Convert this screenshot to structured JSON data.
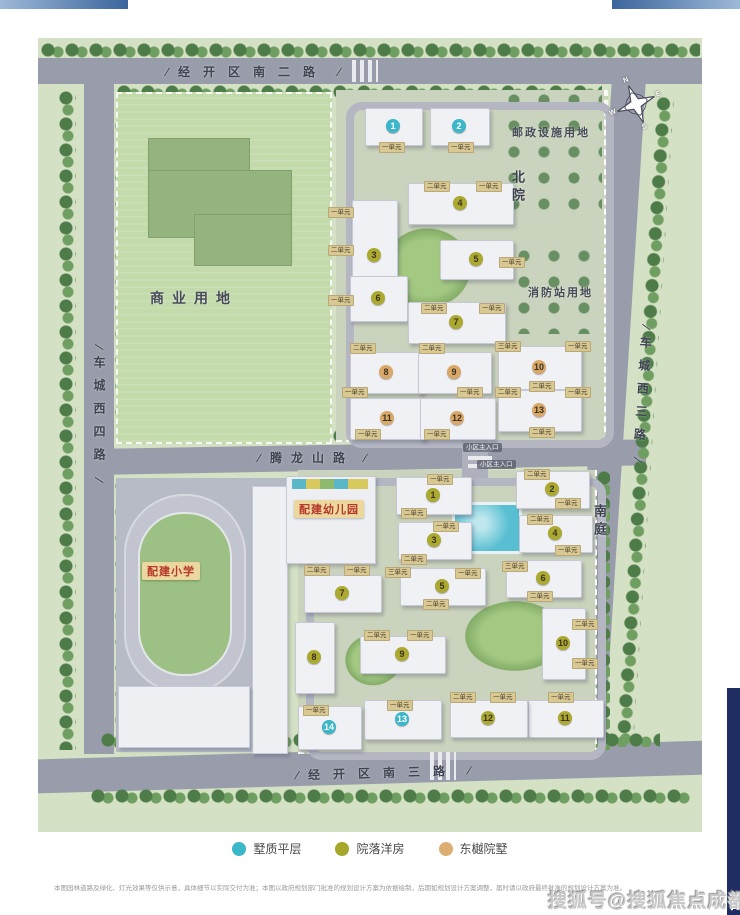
{
  "map": {
    "roads": {
      "top": {
        "label": "经开区南二路"
      },
      "bottom": {
        "label": "经开区南三路"
      },
      "left": {
        "label": "车城西四路"
      },
      "right": {
        "label": "车城西三路"
      },
      "middle": {
        "label": "腾龙山路"
      }
    },
    "areas": {
      "commercial": {
        "label": "商业用地"
      },
      "postal": {
        "label": "邮政设施用地"
      },
      "fire": {
        "label": "消防站用地"
      }
    },
    "sections": {
      "north": {
        "label": "北院"
      },
      "south": {
        "label": "南庭"
      }
    },
    "facilities": {
      "kindergarten": {
        "label": "配建幼儿园"
      },
      "school": {
        "label": "配建小学"
      }
    },
    "entrances": [
      {
        "label": "小区主入口",
        "x": 445,
        "y": 410
      },
      {
        "label": "小区主入口",
        "x": 459,
        "y": 427
      }
    ],
    "compass": {
      "n": "N",
      "e": "E",
      "s": "S",
      "w": "W"
    },
    "marker_colors": {
      "flat": "#3cb6c9",
      "terrace": "#aca930",
      "courtyard": "#d9a868"
    },
    "buildings": {
      "north": [
        {
          "n": "1",
          "type": "flat",
          "x": 327,
          "y": 70,
          "w": 56,
          "h": 36
        },
        {
          "n": "2",
          "type": "flat",
          "x": 392,
          "y": 70,
          "w": 58,
          "h": 36
        },
        {
          "n": "3",
          "type": "terrace",
          "x": 314,
          "y": 162,
          "w": 44,
          "h": 110
        },
        {
          "n": "4",
          "type": "terrace",
          "x": 370,
          "y": 145,
          "w": 104,
          "h": 40
        },
        {
          "n": "5",
          "type": "terrace",
          "x": 402,
          "y": 202,
          "w": 72,
          "h": 38
        },
        {
          "n": "6",
          "type": "terrace",
          "x": 312,
          "y": 238,
          "w": 56,
          "h": 44
        },
        {
          "n": "7",
          "type": "terrace",
          "x": 370,
          "y": 264,
          "w": 96,
          "h": 40
        },
        {
          "n": "8",
          "type": "courtyard",
          "x": 312,
          "y": 314,
          "w": 72,
          "h": 40
        },
        {
          "n": "9",
          "type": "courtyard",
          "x": 380,
          "y": 314,
          "w": 72,
          "h": 40
        },
        {
          "n": "10",
          "type": "courtyard",
          "x": 460,
          "y": 308,
          "w": 82,
          "h": 42
        },
        {
          "n": "11",
          "type": "courtyard",
          "x": 312,
          "y": 360,
          "w": 74,
          "h": 40
        },
        {
          "n": "12",
          "type": "courtyard",
          "x": 382,
          "y": 360,
          "w": 74,
          "h": 40
        },
        {
          "n": "13",
          "type": "courtyard",
          "x": 460,
          "y": 352,
          "w": 82,
          "h": 40
        }
      ],
      "south": [
        {
          "n": "1",
          "type": "terrace",
          "x": 358,
          "y": 439,
          "w": 74,
          "h": 36
        },
        {
          "n": "2",
          "type": "terrace",
          "x": 478,
          "y": 433,
          "w": 72,
          "h": 36
        },
        {
          "n": "3",
          "type": "terrace",
          "x": 360,
          "y": 484,
          "w": 72,
          "h": 36
        },
        {
          "n": "4",
          "type": "terrace",
          "x": 481,
          "y": 477,
          "w": 72,
          "h": 36
        },
        {
          "n": "5",
          "type": "terrace",
          "x": 362,
          "y": 530,
          "w": 84,
          "h": 36
        },
        {
          "n": "6",
          "type": "terrace",
          "x": 468,
          "y": 522,
          "w": 74,
          "h": 36
        },
        {
          "n": "7",
          "type": "terrace",
          "x": 266,
          "y": 537,
          "w": 76,
          "h": 36
        },
        {
          "n": "8",
          "type": "terrace",
          "x": 257,
          "y": 584,
          "w": 38,
          "h": 70
        },
        {
          "n": "9",
          "type": "terrace",
          "x": 322,
          "y": 598,
          "w": 84,
          "h": 36
        },
        {
          "n": "10",
          "type": "terrace",
          "x": 504,
          "y": 570,
          "w": 42,
          "h": 70
        },
        {
          "n": "11",
          "type": "terrace",
          "x": 490,
          "y": 662,
          "w": 74,
          "h": 36
        },
        {
          "n": "12",
          "type": "terrace",
          "x": 412,
          "y": 662,
          "w": 76,
          "h": 36
        },
        {
          "n": "13",
          "type": "flat",
          "x": 326,
          "y": 662,
          "w": 76,
          "h": 38
        },
        {
          "n": "14",
          "type": "flat",
          "x": 260,
          "y": 668,
          "w": 62,
          "h": 42
        }
      ]
    },
    "unit_tags": [
      {
        "x": 354,
        "y": 109,
        "label": "一单元"
      },
      {
        "x": 423,
        "y": 109,
        "label": "一单元"
      },
      {
        "x": 399,
        "y": 148,
        "label": "二单元"
      },
      {
        "x": 451,
        "y": 148,
        "label": "一单元"
      },
      {
        "x": 303,
        "y": 174,
        "label": "一单元"
      },
      {
        "x": 303,
        "y": 212,
        "label": "二单元"
      },
      {
        "x": 474,
        "y": 224,
        "label": "一单元"
      },
      {
        "x": 303,
        "y": 262,
        "label": "一单元"
      },
      {
        "x": 396,
        "y": 270,
        "label": "二单元"
      },
      {
        "x": 454,
        "y": 270,
        "label": "一单元"
      },
      {
        "x": 325,
        "y": 310,
        "label": "二单元"
      },
      {
        "x": 394,
        "y": 310,
        "label": "二单元"
      },
      {
        "x": 470,
        "y": 308,
        "label": "三单元"
      },
      {
        "x": 540,
        "y": 308,
        "label": "一单元"
      },
      {
        "x": 317,
        "y": 354,
        "label": "一单元"
      },
      {
        "x": 432,
        "y": 354,
        "label": "一单元"
      },
      {
        "x": 504,
        "y": 348,
        "label": "二单元"
      },
      {
        "x": 470,
        "y": 354,
        "label": "二单元"
      },
      {
        "x": 540,
        "y": 354,
        "label": "一单元"
      },
      {
        "x": 330,
        "y": 396,
        "label": "一单元"
      },
      {
        "x": 399,
        "y": 396,
        "label": "一单元"
      },
      {
        "x": 504,
        "y": 394,
        "label": "二单元"
      },
      {
        "x": 402,
        "y": 441,
        "label": "一单元"
      },
      {
        "x": 499,
        "y": 436,
        "label": "二单元"
      },
      {
        "x": 530,
        "y": 465,
        "label": "一单元"
      },
      {
        "x": 376,
        "y": 475,
        "label": "二单元"
      },
      {
        "x": 408,
        "y": 488,
        "label": "一单元"
      },
      {
        "x": 502,
        "y": 481,
        "label": "二单元"
      },
      {
        "x": 530,
        "y": 512,
        "label": "一单元"
      },
      {
        "x": 376,
        "y": 521,
        "label": "二单元"
      },
      {
        "x": 360,
        "y": 534,
        "label": "三单元"
      },
      {
        "x": 430,
        "y": 535,
        "label": "一单元"
      },
      {
        "x": 477,
        "y": 528,
        "label": "三单元"
      },
      {
        "x": 502,
        "y": 558,
        "label": "二单元"
      },
      {
        "x": 398,
        "y": 566,
        "label": "二单元"
      },
      {
        "x": 279,
        "y": 532,
        "label": "二单元"
      },
      {
        "x": 319,
        "y": 532,
        "label": "一单元"
      },
      {
        "x": 547,
        "y": 586,
        "label": "二单元"
      },
      {
        "x": 339,
        "y": 597,
        "label": "二单元"
      },
      {
        "x": 382,
        "y": 597,
        "label": "一单元"
      },
      {
        "x": 547,
        "y": 625,
        "label": "一单元"
      },
      {
        "x": 278,
        "y": 672,
        "label": "一单元"
      },
      {
        "x": 362,
        "y": 667,
        "label": "一单元"
      },
      {
        "x": 425,
        "y": 659,
        "label": "二单元"
      },
      {
        "x": 465,
        "y": 659,
        "label": "一单元"
      },
      {
        "x": 523,
        "y": 659,
        "label": "一单元"
      }
    ]
  },
  "legend": {
    "items": [
      {
        "label": "墅质平层",
        "color": "#3cb6c9"
      },
      {
        "label": "院落洋房",
        "color": "#a6a72b"
      },
      {
        "label": "东樾院墅",
        "color": "#dcae72"
      }
    ]
  },
  "footer": {
    "disclaimer": "本图园林道路及绿化、灯光效果等仅供示意，具体细节以实际交付为准；本图以政府规划部门批准的规划设计方案为依据绘制，后期如规划设计方案调整，届时请以政府最终批准的规划设计方案为准。",
    "watermark": "搜狐号@搜狐焦点成都站"
  }
}
